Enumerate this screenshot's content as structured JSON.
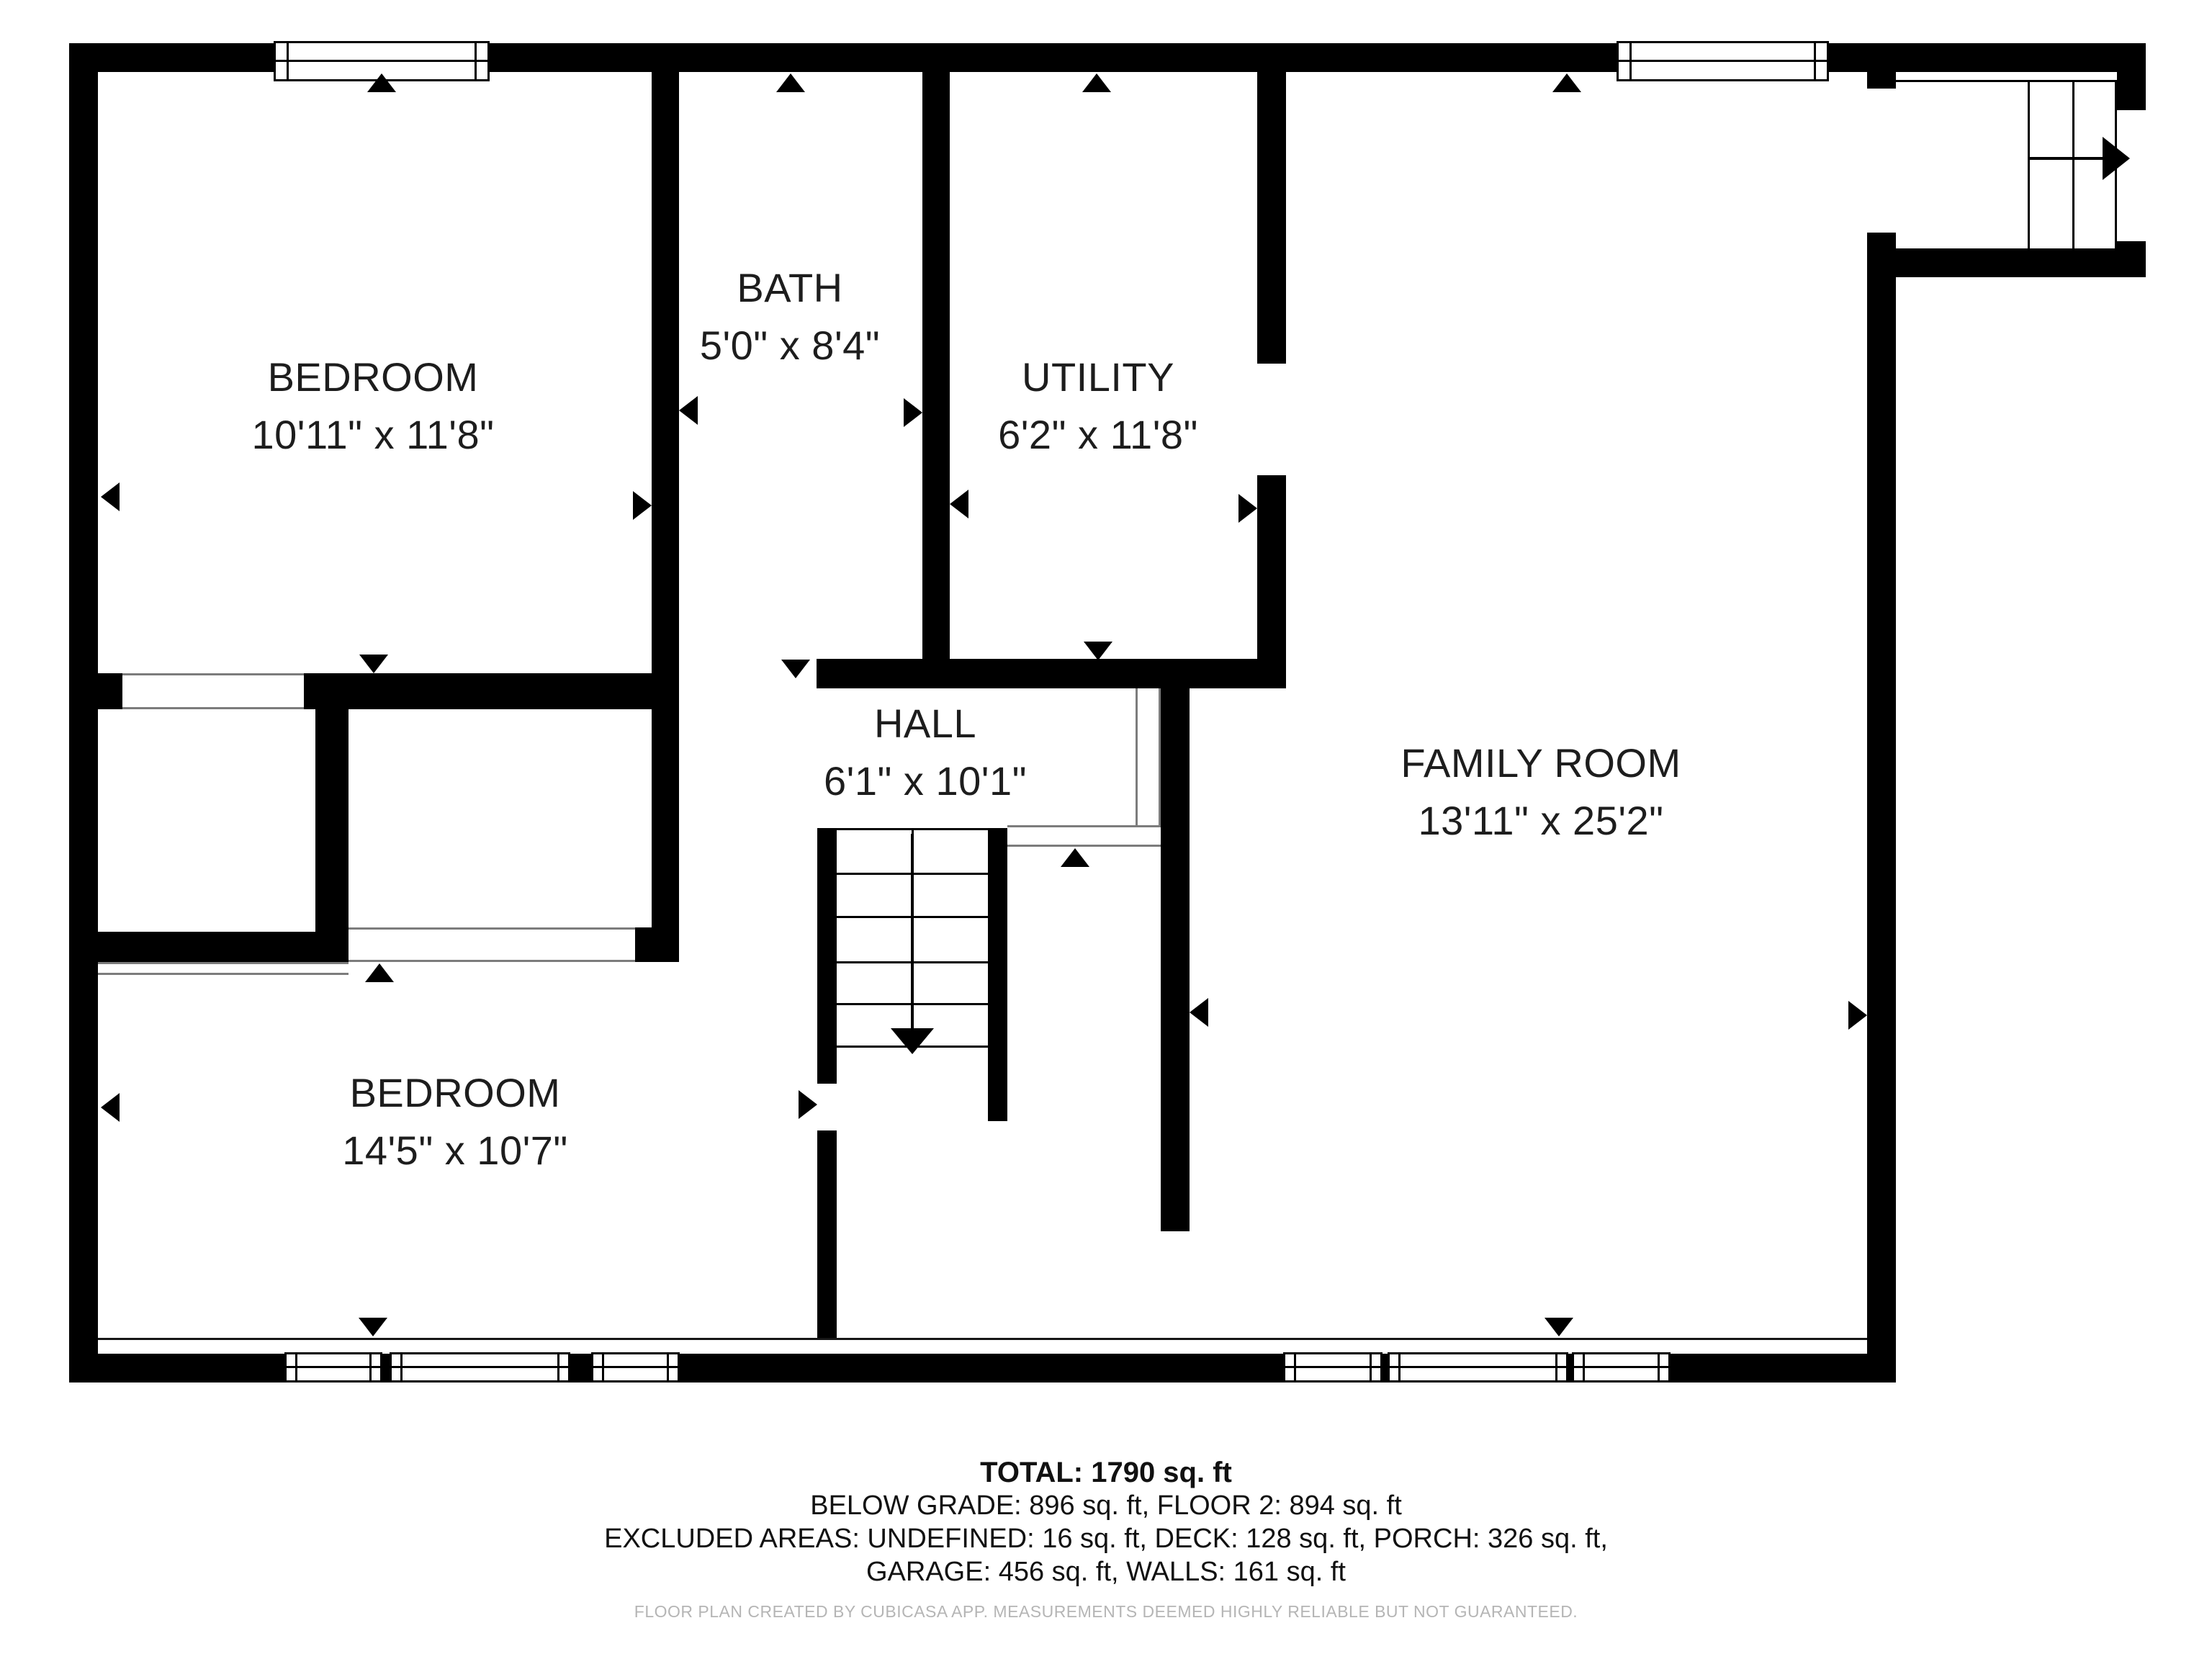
{
  "rooms": [
    {
      "name": "BEDROOM",
      "dims": "10'11\" x 11'8\""
    },
    {
      "name": "BATH",
      "dims": "5'0\" x 8'4\""
    },
    {
      "name": "UTILITY",
      "dims": "6'2\" x 11'8\""
    },
    {
      "name": "HALL",
      "dims": "6'1\" x 10'1\""
    },
    {
      "name": "FAMILY ROOM",
      "dims": "13'11\" x 25'2\""
    },
    {
      "name": "BEDROOM",
      "dims": "14'5\" x 10'7\""
    }
  ],
  "summary": {
    "total": "TOTAL: 1790 sq. ft",
    "line2": "BELOW GRADE: 896 sq. ft, FLOOR 2: 894 sq. ft",
    "line3": "EXCLUDED AREAS: UNDEFINED: 16 sq. ft, DECK: 128 sq. ft, PORCH: 326 sq. ft,",
    "line4": "GARAGE: 456 sq. ft, WALLS: 161 sq. ft",
    "disclaimer": "FLOOR PLAN CREATED BY CUBICASA APP. MEASUREMENTS DEEMED HIGHLY RELIABLE BUT NOT GUARANTEED."
  },
  "colors": {
    "wall": "#000000",
    "label_text": "#1d1d1d",
    "muted_text": "#b5b5b5",
    "opening_line": "#7c7c7c"
  }
}
